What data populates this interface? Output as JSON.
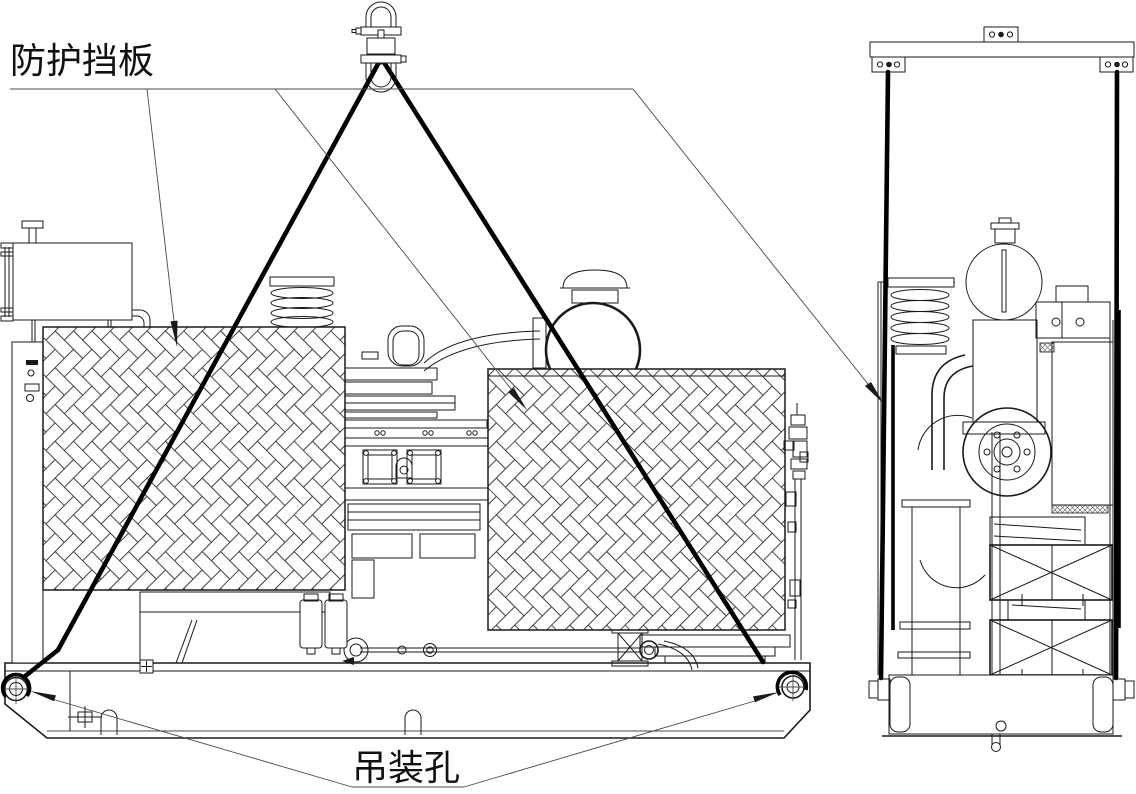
{
  "drawing": {
    "labels": {
      "guard_plate": "防护挡板",
      "lifting_hole": "吊装孔"
    },
    "colors": {
      "background": "#ffffff",
      "line": "#1a1a1a",
      "sling": "#000000",
      "hatch": "#3c3c3c",
      "label": "#111111"
    }
  }
}
